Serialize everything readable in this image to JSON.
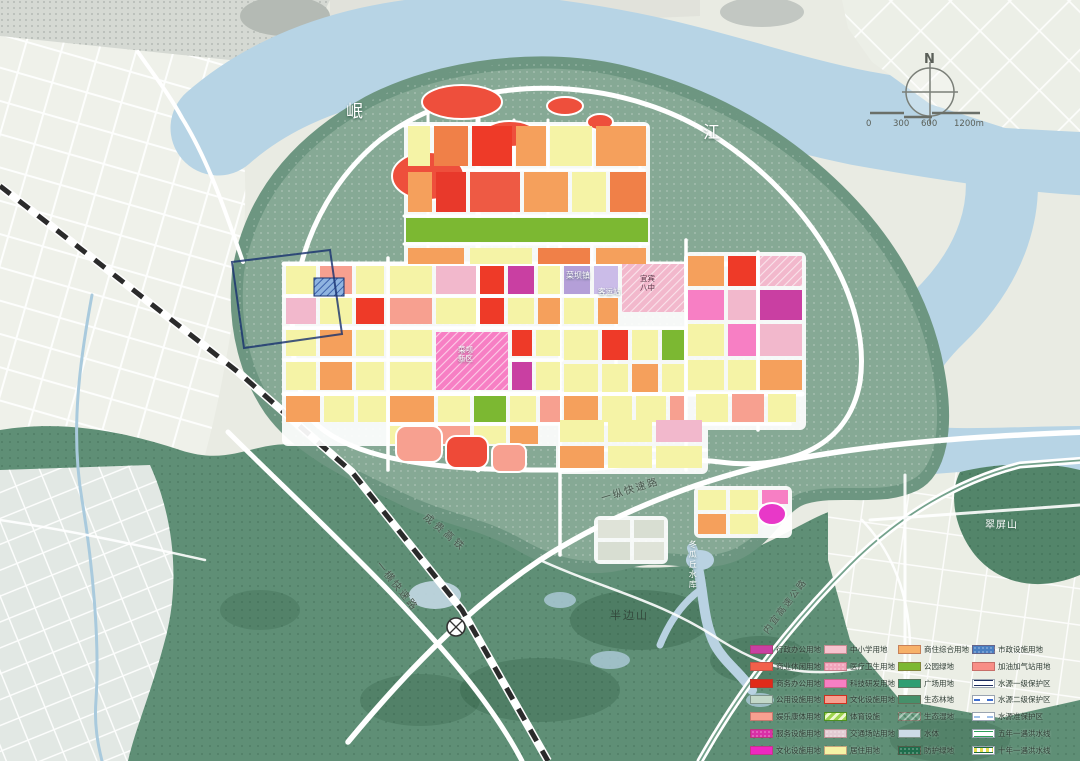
{
  "palette": {
    "river": "#b7d4e5",
    "peninsula_green": "#86a995",
    "forest_green": "#5f8f76",
    "road_white": "#ffffff",
    "terrain_light": "#e9ebe3"
  },
  "compass": {
    "north": "N"
  },
  "scale_bar": {
    "t0": "0",
    "t1": "300",
    "t2": "600",
    "t3": "1200m"
  },
  "map_labels": {
    "river1": "岷",
    "river2": "江",
    "town": "菜坝镇",
    "station": "客运站",
    "school1": "宜宾",
    "school2": "八中",
    "block1": "菜坝",
    "block2": "新区",
    "rd_ns": "一纵快速路",
    "rd_ew": "一横快速路",
    "rail": "成贵高铁",
    "hwy": "内宜高速公路",
    "reservoir": "冬瓜丘水库",
    "mt_s": "半边山",
    "mt_e": "翠屏山"
  },
  "legend": {
    "columns": [
      [
        {
          "label": "行政办公用地",
          "color": "#c93fa2",
          "style": "solid"
        },
        {
          "label": "商业休闲用地",
          "color": "#f2604a",
          "style": "solid"
        },
        {
          "label": "商务办公用地",
          "color": "#e02a1a",
          "style": "solid"
        },
        {
          "label": "公用设施用地",
          "color": "#c2d8c8",
          "style": "solid-border"
        },
        {
          "label": "娱乐康体用地",
          "color": "#f7a090",
          "style": "solid"
        },
        {
          "label": "服务设施用地",
          "color": "#d92fa6",
          "style": "dotted"
        },
        {
          "label": "文化设施用地",
          "color": "#ee28c0",
          "style": "solid"
        }
      ],
      [
        {
          "label": "中小学用地",
          "color": "#f7c3cf",
          "style": "solid"
        },
        {
          "label": "医疗卫生用地",
          "color": "#f2a4bb",
          "style": "dotted"
        },
        {
          "label": "科技研发用地",
          "color": "#f77fc4",
          "style": "solid"
        },
        {
          "label": "文化设施用地",
          "color": "#f7a090",
          "style": "solid-border-red"
        },
        {
          "label": "体育设施",
          "color": "#8fd24f",
          "style": "hatch"
        },
        {
          "label": "交通场站用地",
          "color": "#e3ccd4",
          "style": "dotted"
        },
        {
          "label": "居住用地",
          "color": "#f5f3a6",
          "style": "solid"
        }
      ],
      [
        {
          "label": "商住综合用地",
          "color": "#f7b169",
          "style": "solid"
        },
        {
          "label": "公园绿地",
          "color": "#7cb832",
          "style": "solid"
        },
        {
          "label": "广场用地",
          "color": "#2f9e72",
          "style": "solid"
        },
        {
          "label": "生态林地",
          "color": "#46906a",
          "style": "solid"
        },
        {
          "label": "生态湿地",
          "color": "#6fa287",
          "style": "texture"
        },
        {
          "label": "水体",
          "color": "#ccdbe6",
          "style": "solid-border"
        },
        {
          "label": "防护绿地",
          "color": "#1e6e4c",
          "style": "dotted"
        }
      ],
      [
        {
          "label": "市政设施用地",
          "color": "#4a7fc2",
          "style": "dotted"
        },
        {
          "label": "加油加气站用地",
          "color": "#f88e86",
          "style": "solid"
        },
        {
          "label": "水源一级保护区",
          "color": "#1a2a5e",
          "style": "line-double"
        },
        {
          "label": "水源二级保护区",
          "color": "#3f6fd0",
          "style": "line-dashed"
        },
        {
          "label": "水源准保护区",
          "color": "#9fc0ea",
          "style": "line-dashed"
        },
        {
          "label": "五年一遇洪水线",
          "color": "#2fa05a",
          "style": "line-double"
        },
        {
          "label": "十年一遇洪水线",
          "color": "#1e6e3c",
          "style": "line-dash-center"
        }
      ]
    ]
  }
}
